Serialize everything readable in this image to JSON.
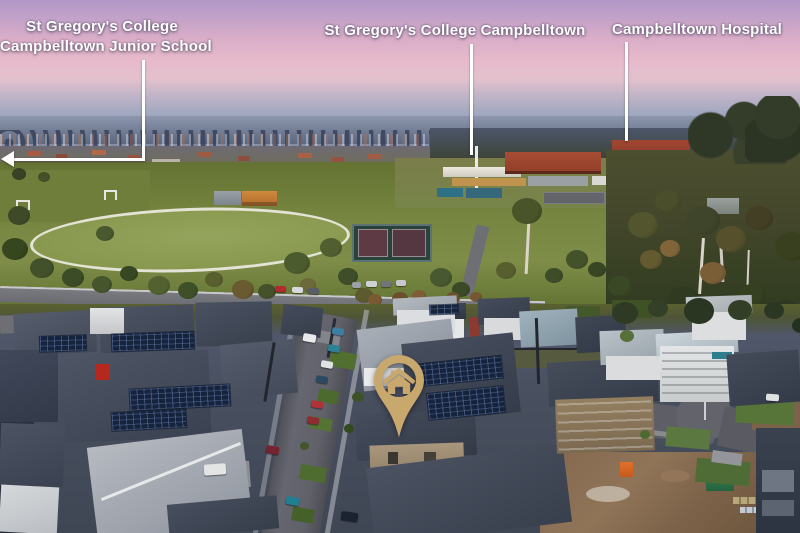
{
  "annotations": {
    "labels": [
      {
        "line1": "St Gregory's College",
        "line2": "Campbelltown Junior School"
      },
      {
        "line1": "St Gregory's College Campbelltown"
      },
      {
        "line1": "Campbelltown Hospital"
      }
    ],
    "marker": {
      "name": "property-location-pin",
      "icon": "house-icon",
      "color": "#c8a86c"
    },
    "style": {
      "text_color": "#ffffff",
      "leader_color": "#ffffff"
    }
  }
}
